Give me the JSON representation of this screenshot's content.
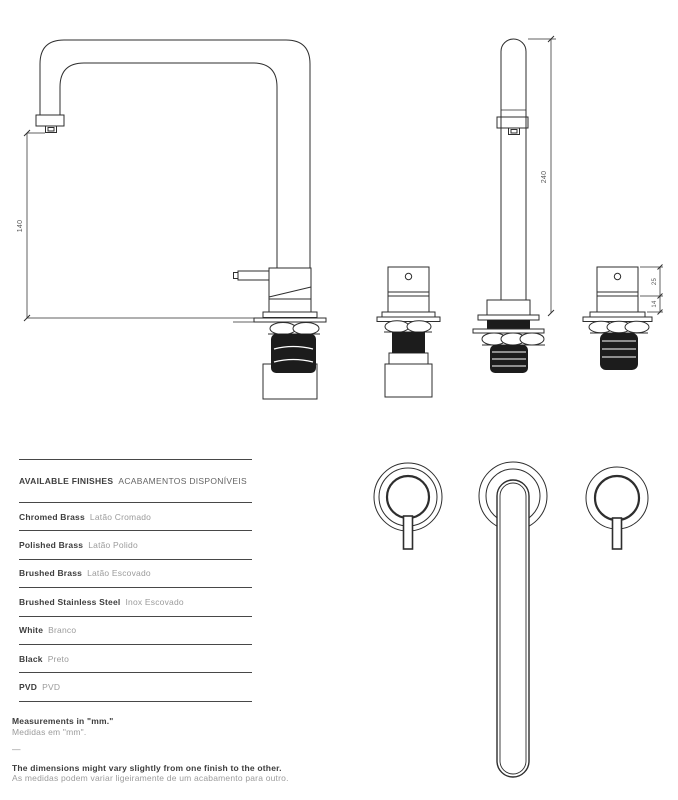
{
  "colors": {
    "line": "#2e2e2e",
    "solid_fill": "#1c1c1c",
    "rule": "#474747",
    "text_dark": "#3d3d3d",
    "text_gray": "#9b9b9b",
    "dim_text": "#5a5a5a",
    "background": "#ffffff"
  },
  "drawings": {
    "units": "mm",
    "side_view": {
      "height_label": "140"
    },
    "front_view": {
      "height_label": "240"
    },
    "valve_view": {
      "handle_height_label": "25",
      "body_height_label": "14"
    }
  },
  "finishes": {
    "title_en": "AVAILABLE FINISHES",
    "title_pt": "ACABAMENTOS DISPONÍVEIS",
    "rows": [
      {
        "en": "Chromed Brass",
        "pt": "Latão Cromado"
      },
      {
        "en": "Polished Brass",
        "pt": "Latão Polido"
      },
      {
        "en": "Brushed Brass",
        "pt": "Latão Escovado"
      },
      {
        "en": "Brushed Stainless Steel",
        "pt": "Inox Escovado"
      },
      {
        "en": "White",
        "pt": "Branco"
      },
      {
        "en": "Black",
        "pt": "Preto"
      },
      {
        "en": "PVD",
        "pt": "PVD"
      }
    ]
  },
  "notes": {
    "measurements_en": "Measurements in \"mm.\"",
    "measurements_pt": "Medidas em \"mm\".",
    "separator": "—",
    "tolerance_en": "The dimensions might vary slightly from one finish to the other.",
    "tolerance_pt": "As medidas podem variar ligeiramente de um acabamento para outro."
  }
}
